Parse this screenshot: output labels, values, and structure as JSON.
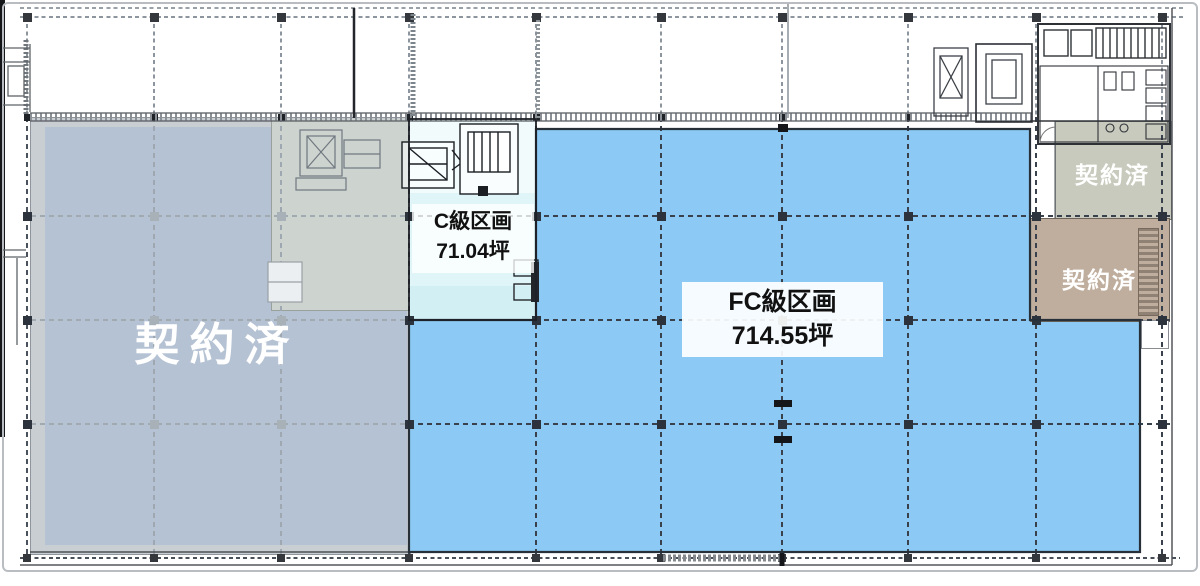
{
  "zones": {
    "leased_left": {
      "label": "契約済"
    },
    "c_section": {
      "name": "C級区画",
      "area": "71.04坪"
    },
    "fc_section": {
      "name": "FC級区画",
      "area": "714.55坪"
    },
    "leased_upper_right": {
      "label": "契約済"
    },
    "leased_lower_right": {
      "label": "契約済"
    }
  },
  "colors": {
    "available_blue": "#8CC9F4",
    "c_section_cyan": "#E0F5F8",
    "leased_left_fill": "#B5C2D3",
    "leased_left_band": "#C9CED3",
    "leased_left_upper": "#CDD4D0",
    "leased_upper_right": "#C8CABD",
    "leased_lower_right": "#BFAE9D",
    "grid_dark": "#39414C",
    "grid_light": "#9FA8B0",
    "wall_black": "#14161A",
    "label_text": "#111111",
    "leased_text": "#FFFFFF"
  }
}
